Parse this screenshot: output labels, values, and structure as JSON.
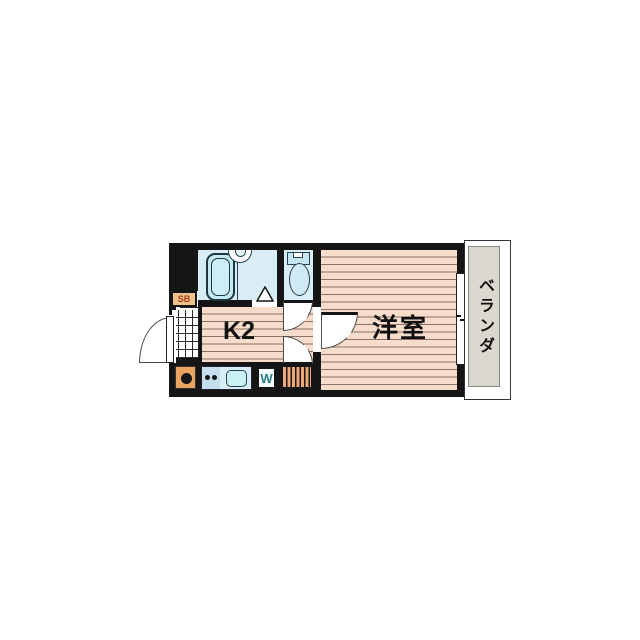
{
  "plan": {
    "type": "apartment-floor-plan",
    "rooms": {
      "kitchen_label": "K2",
      "western_room_label": "洋室",
      "balcony_label": "ベランダ",
      "shoe_box_label": "SB",
      "washer_label": "W"
    },
    "fixtures": [
      "bathtub",
      "wash-basin",
      "toilet",
      "stove-burner",
      "kitchen-sink",
      "washing-machine-space",
      "entrance-tiles",
      "step-hatch"
    ],
    "colors": {
      "wall": "#151515",
      "floor_base": "#f6dcca",
      "floor_stripe": "#8d7066",
      "wet_area": "#d8edf5",
      "fixture_fill": "#c9ecf5",
      "balcony_panel": "#dcd8d0",
      "stove_box": "#e9a55f",
      "hatch_box": "#efa878",
      "shoe_box_bg": "#eec28e",
      "shoe_box_text": "#b03a10",
      "washer_text": "#2a7f85"
    }
  }
}
